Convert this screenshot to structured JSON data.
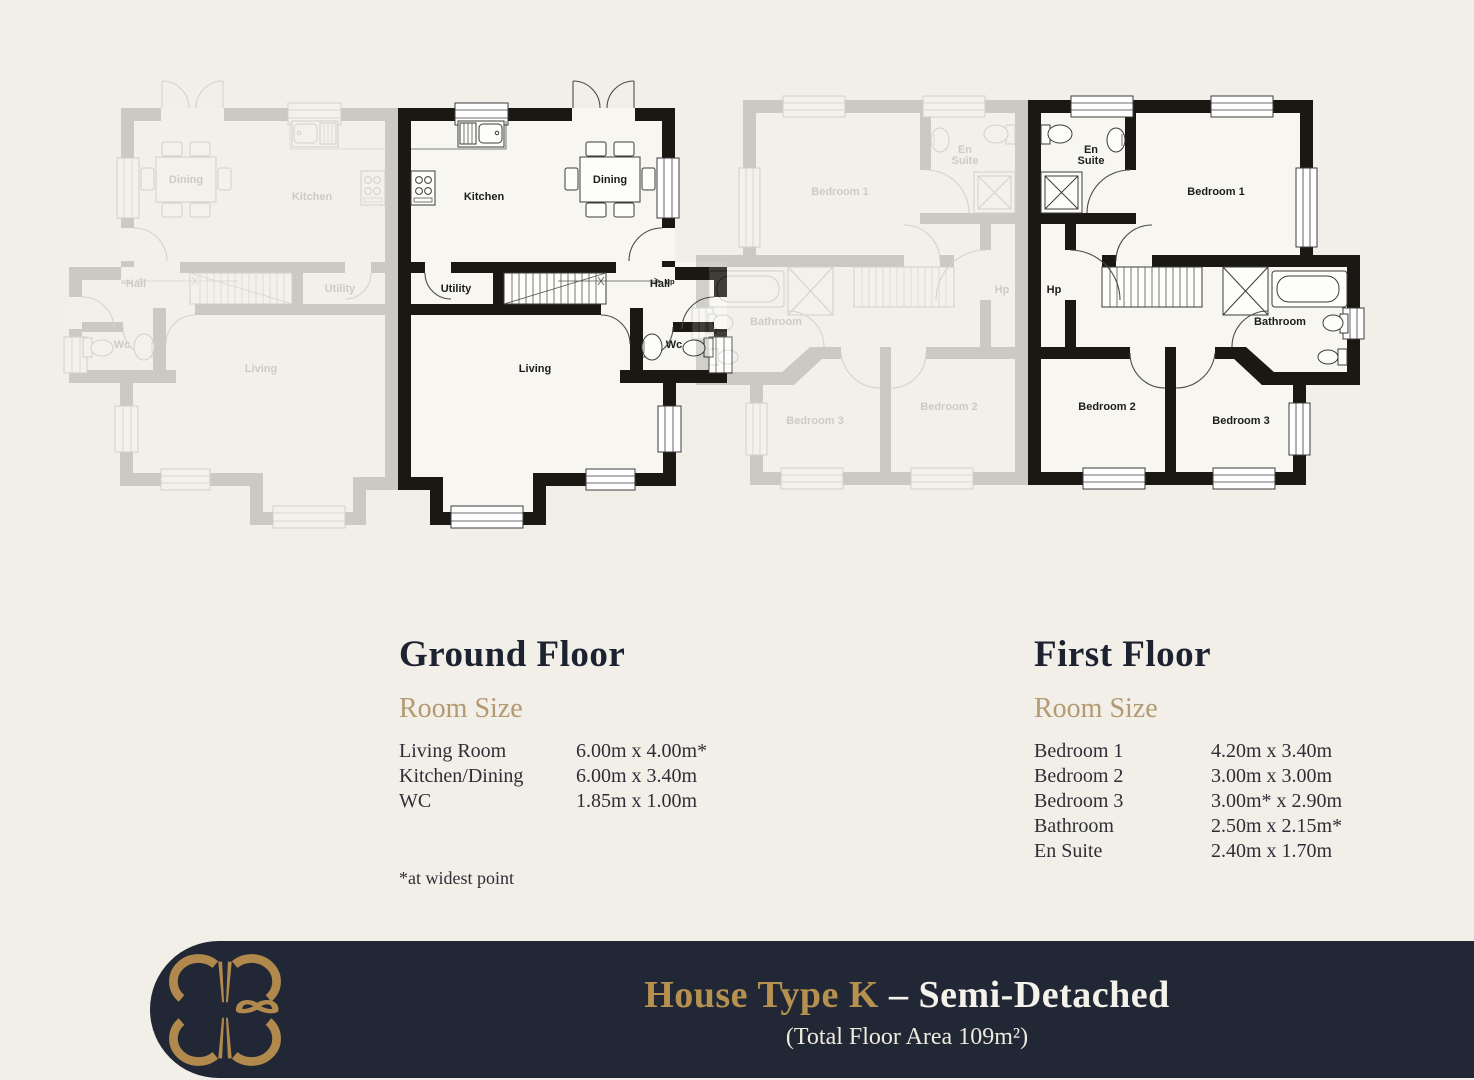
{
  "colors": {
    "page_background": "#f1efe8",
    "footer_background": "#212735",
    "accent_gold": "#b6904f",
    "room_size_gold": "#b39a72",
    "heading_navy": "#1d2230",
    "plan_wall": "#1b1712"
  },
  "ground_floor": {
    "heading": "Ground Floor",
    "subheading": "Room Size",
    "rooms": [
      {
        "name": "Living Room",
        "size": "6.00m x 4.00m*"
      },
      {
        "name": "Kitchen/Dining",
        "size": "6.00m x 3.40m"
      },
      {
        "name": "WC",
        "size": "1.85m x 1.00m"
      }
    ],
    "footnote": "*at widest point",
    "plan_labels": [
      {
        "text": "Kitchen",
        "x": 86,
        "y": 125
      },
      {
        "text": "Dining",
        "x": 212,
        "y": 108
      },
      {
        "text": "Utility",
        "x": 58,
        "y": 217
      },
      {
        "text": "Hall",
        "x": 262,
        "y": 212
      },
      {
        "text": "Wc",
        "x": 276,
        "y": 273
      },
      {
        "text": "Living",
        "x": 137,
        "y": 297
      },
      {
        "text": "up",
        "x": 272,
        "y": 209,
        "small": true
      }
    ]
  },
  "first_floor": {
    "heading": "First Floor",
    "subheading": "Room Size",
    "rooms": [
      {
        "name": "Bedroom 1",
        "size": "4.20m x 3.40m"
      },
      {
        "name": "Bedroom 2",
        "size": "3.00m x 3.00m"
      },
      {
        "name": "Bedroom 3",
        "size": "3.00m* x 2.90m"
      },
      {
        "name": "Bathroom",
        "size": "2.50m x 2.15m*"
      },
      {
        "name": "En Suite",
        "size": "2.40m x 1.70m"
      }
    ],
    "plan_labels": [
      {
        "lines": [
          "En",
          "Suite"
        ],
        "x": 63,
        "y": 58
      },
      {
        "text": "Bedroom 1",
        "x": 188,
        "y": 100
      },
      {
        "text": "Hp",
        "x": 26,
        "y": 198
      },
      {
        "text": "Bathroom",
        "x": 252,
        "y": 230
      },
      {
        "text": "Bedroom 2",
        "x": 79,
        "y": 315
      },
      {
        "text": "Bedroom 3",
        "x": 213,
        "y": 329
      }
    ]
  },
  "footer": {
    "title_accent": "House Type K",
    "title_dash": "–",
    "title_main": "Semi-Detached",
    "subtitle": "(Total Floor Area 109m²)"
  }
}
